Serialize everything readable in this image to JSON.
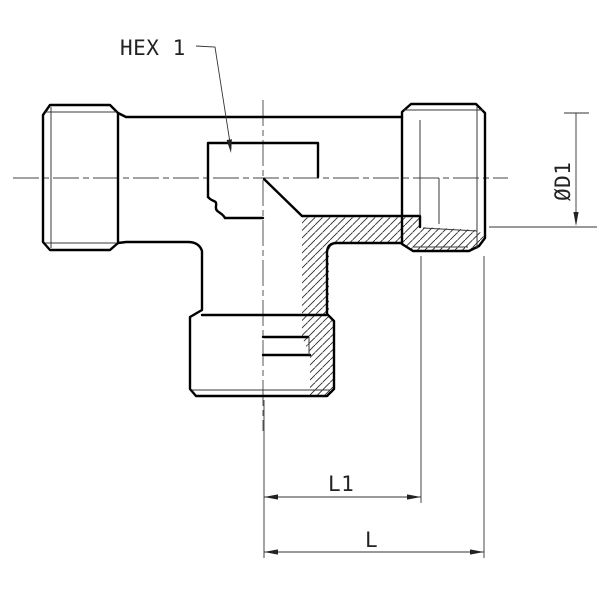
{
  "drawing": {
    "type": "technical-drawing",
    "subject": "tee-fitting-cross-section",
    "labels": {
      "hex_callout": "HEX 1",
      "diameter_dim": "ØD1",
      "length_dim_inner": "L1",
      "length_dim_outer": "L"
    },
    "colors": {
      "background": "#ffffff",
      "outline": "#000000",
      "thin_line": "#3a3a3a",
      "dimension_line": "#333333"
    }
  }
}
